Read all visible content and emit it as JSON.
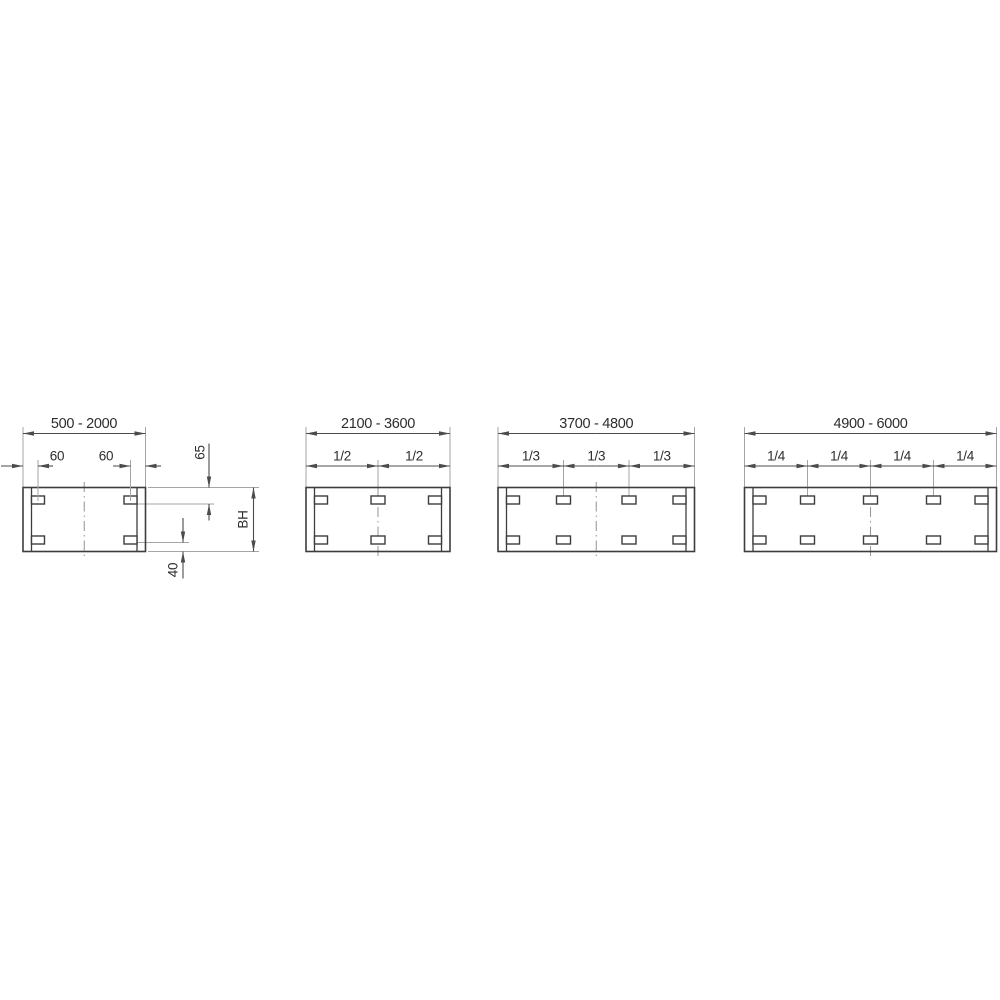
{
  "diagram": {
    "panels": [
      {
        "range": "500 - 2000",
        "left_slot_offset": "60",
        "right_slot_offset": "60",
        "top_offset": "65",
        "height_label": "BH",
        "bottom_offset": "40"
      },
      {
        "range": "2100 - 3600",
        "fractions": [
          "1/2",
          "1/2"
        ]
      },
      {
        "range": "3700 - 4800",
        "fractions": [
          "1/3",
          "1/3",
          "1/3"
        ]
      },
      {
        "range": "4900 - 6000",
        "fractions": [
          "1/4",
          "1/4",
          "1/4",
          "1/4"
        ]
      }
    ],
    "colors": {
      "outline": "#3d3d3f",
      "dimension": "#4b4b4d",
      "extension": "#a5a5a8",
      "centerline": "#98989b",
      "text": "#2d2d2f",
      "background": "#ffffff"
    }
  }
}
